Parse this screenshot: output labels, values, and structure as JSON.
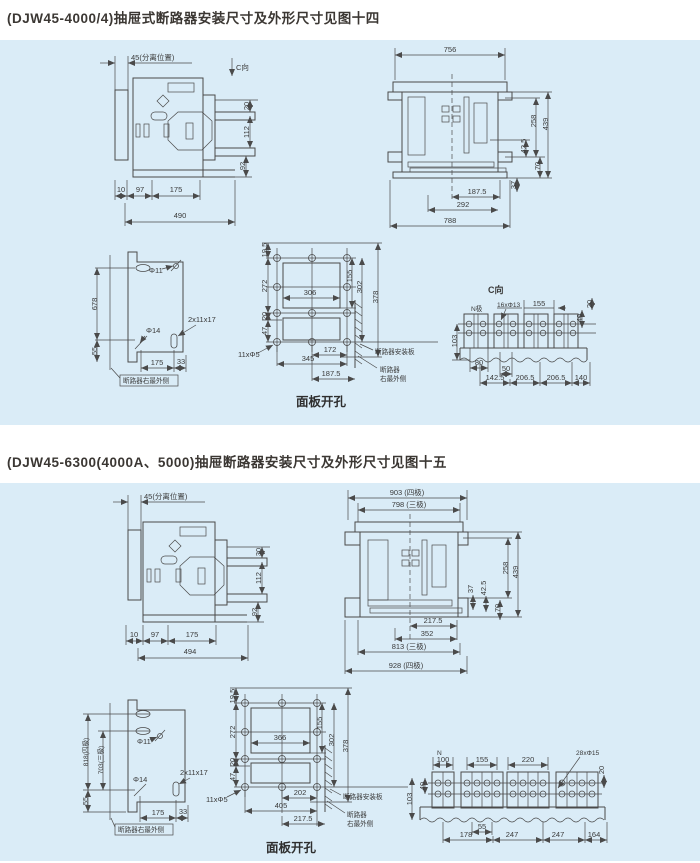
{
  "page": {
    "background": "#ffffff",
    "panel_background": "#daecf7",
    "line_color": "#4a4a4a",
    "section1": {
      "title": "(DJW45-4000/4)抽屉式断路器安装尺寸及外形尺寸见图十四"
    },
    "section2": {
      "title": "(DJW45-6300(4000A、5000)抽屉断路器安装尺寸及外形尺寸见图十五"
    }
  },
  "fig14": {
    "side": {
      "d45": "45(分离位置)",
      "c": "C向",
      "d20": "20",
      "d112": "112",
      "d92": "92",
      "d10": "10",
      "d97": "97",
      "d175": "175",
      "d490": "490"
    },
    "front": {
      "d756": "756",
      "d439": "439",
      "d258": "258",
      "d425": "42.5",
      "d70": "70",
      "d37": "37",
      "d1875": "187.5",
      "d292": "292",
      "d788": "788"
    },
    "drill": {
      "d678": "678",
      "d55": "55",
      "phi11": "Φ11",
      "phi14": "Φ14",
      "slot": "2x11x17",
      "d175": "175",
      "d33": "33",
      "ref": "断路器右最外侧"
    },
    "cutout": {
      "d195": "19.5",
      "d272": "272",
      "d20": "20",
      "d47": "47",
      "d155": "155",
      "d302": "302",
      "d378": "378",
      "d306": "306",
      "d172": "172",
      "d345": "345",
      "d1875": "187.5",
      "holes": "11xΦ5",
      "plate": "断路器安装板",
      "ref1": "断路器",
      "ref2": "右最外侧",
      "caption": "面板开孔"
    },
    "cview": {
      "title": "C向",
      "n": "N极",
      "holes": "16xΦ13",
      "d155": "155",
      "d40": "40",
      "d20": "20",
      "d103": "103",
      "d80": "80",
      "d50": "50",
      "d1425": "142.5",
      "d2065a": "206.5",
      "d2065b": "206.5",
      "d140": "140"
    }
  },
  "fig15": {
    "side": {
      "d45": "45(分离位置)",
      "d30": "30",
      "d112": "112",
      "d92": "92",
      "d10": "10",
      "d97": "97",
      "d175": "175",
      "d494": "494"
    },
    "front": {
      "d903": "903 (四极)",
      "d798": "798 (三极)",
      "d258": "258",
      "d439": "439",
      "d37": "37",
      "d425": "42.5",
      "d70": "70",
      "d2175": "217.5",
      "d352": "352",
      "d813": "813 (三极)",
      "d928": "928 (四极)"
    },
    "drill": {
      "d818": "818(四极)",
      "d703": "703(三极)",
      "phi11": "Φ11",
      "phi14": "Φ14",
      "slot": "2x11x17",
      "d55": "55",
      "d175": "175",
      "d33": "33",
      "ref": "断路器右最外侧"
    },
    "cutout": {
      "d195": "19.5",
      "d272": "272",
      "d20": "20",
      "d47": "47",
      "d155": "155",
      "d302": "302",
      "d378": "378",
      "d366": "366",
      "d202": "202",
      "d405": "405",
      "d2175": "217.5",
      "holes": "11xΦ5",
      "plate": "断路器安装板",
      "ref1": "断路器",
      "ref2": "右最外侧",
      "caption": "面板开孔"
    },
    "cview": {
      "n": "N",
      "d100": "100",
      "d155": "155",
      "d220": "220",
      "holes": "28xΦ15",
      "d20": "20",
      "d103": "103",
      "d40": "40",
      "d55": "55",
      "d178": "178",
      "d247a": "247",
      "d247b": "247",
      "d164": "164"
    }
  }
}
